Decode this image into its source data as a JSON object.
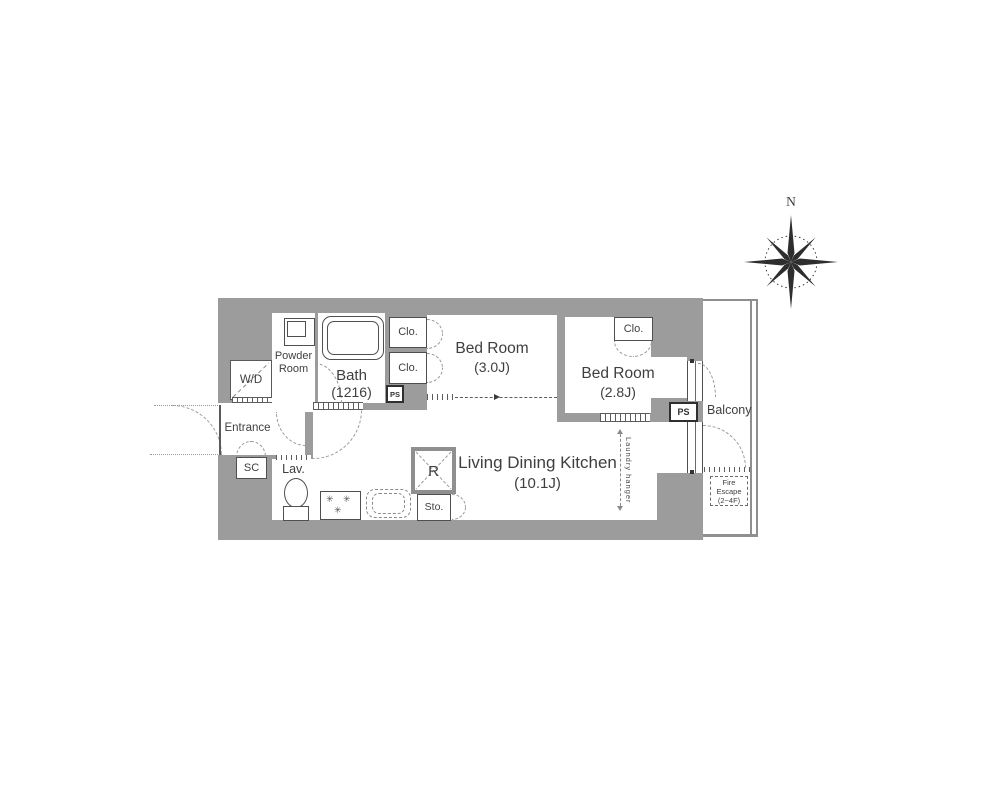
{
  "colors": {
    "wall": "#9c9c9c",
    "line": "#4f4f4f",
    "balcony_line": "#8f8f8f",
    "text": "#3f3f3f"
  },
  "compass": {
    "north": "N"
  },
  "rooms": {
    "bath": {
      "name": "Bath",
      "size": "(1216)"
    },
    "bedroom_1": {
      "name": "Bed Room",
      "size": "(3.0J)"
    },
    "bedroom_2": {
      "name": "Bed Room",
      "size": "(2.8J)"
    },
    "ldk": {
      "name": "Living Dining Kitchen",
      "size": "(10.1J)"
    },
    "powder_room": {
      "line1": "Powder",
      "line2": "Room"
    },
    "entrance": {
      "name": "Entrance"
    },
    "washer_dryer": {
      "name": "W/D"
    },
    "shoe_closet": {
      "name": "SC"
    },
    "lavatory": {
      "name": "Lav."
    },
    "closet": {
      "name": "Clo."
    },
    "pipe_space": {
      "name": "PS"
    },
    "refrigerator": {
      "name": "R"
    },
    "storage": {
      "name": "Sto."
    },
    "balcony": {
      "name": "Balcony"
    }
  },
  "annotations": {
    "laundry_hanger": "Laundry hanger",
    "fire_escape": {
      "line1": "Fire",
      "line2": "Escape",
      "line3": "(2~4F)"
    }
  }
}
